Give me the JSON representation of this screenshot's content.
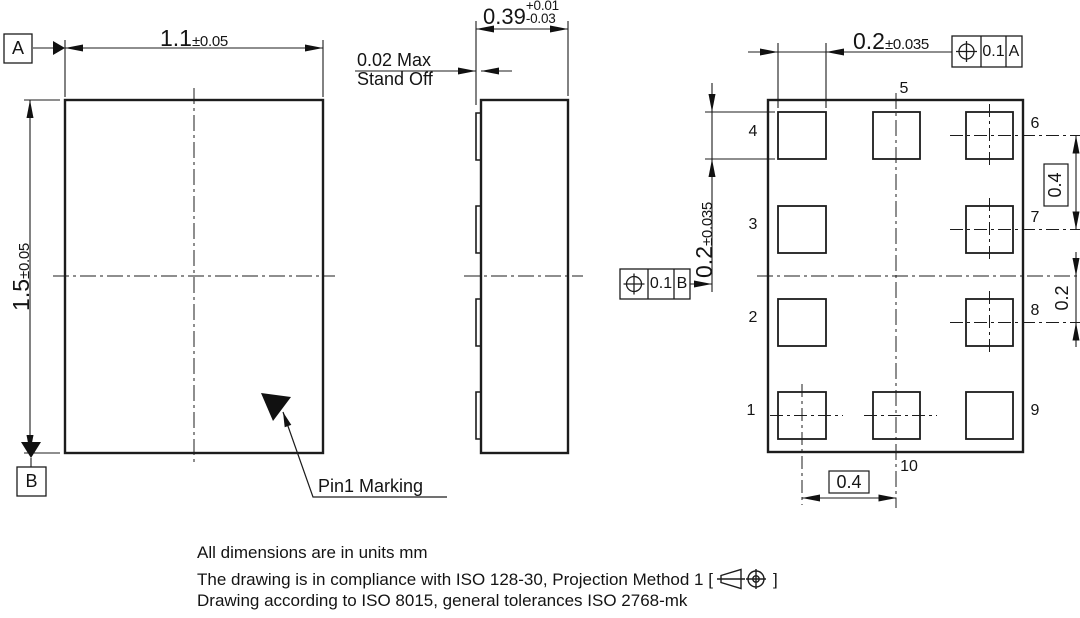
{
  "front_view": {
    "datum_a": "A",
    "datum_b": "B",
    "width": {
      "value": "1.1",
      "tol": "±0.05"
    },
    "height": {
      "value": "1.5",
      "tol": "±0.05"
    },
    "pin1_marking_label": "Pin1 Marking"
  },
  "side_view": {
    "thickness": {
      "value": "0.39",
      "tol_plus": "+0.01",
      "tol_minus": "-0.03"
    },
    "standoff": {
      "line1": "0.02 Max",
      "line2": "Stand Off"
    }
  },
  "bottom_view": {
    "pad_width": {
      "value": "0.2",
      "tol": "±0.035"
    },
    "pad_height": {
      "value": "0.2",
      "tol": "±0.035"
    },
    "fcf_a": {
      "tolerance": "0.1",
      "datum": "A"
    },
    "fcf_b": {
      "tolerance": "0.1",
      "datum": "B"
    },
    "pitch_right": "0.4",
    "pitch_bottom": "0.4",
    "edge_offset": "0.2",
    "pins": [
      "1",
      "2",
      "3",
      "4",
      "5",
      "6",
      "7",
      "8",
      "9",
      "10"
    ]
  },
  "notes": {
    "line1": "All dimensions are in units mm",
    "line2_prefix": "The drawing is in compliance with ISO 128-30, Projection Method 1 [",
    "line2_suffix": "]",
    "line3": "Drawing according to ISO 8015, general tolerances ISO 2768-mk"
  }
}
